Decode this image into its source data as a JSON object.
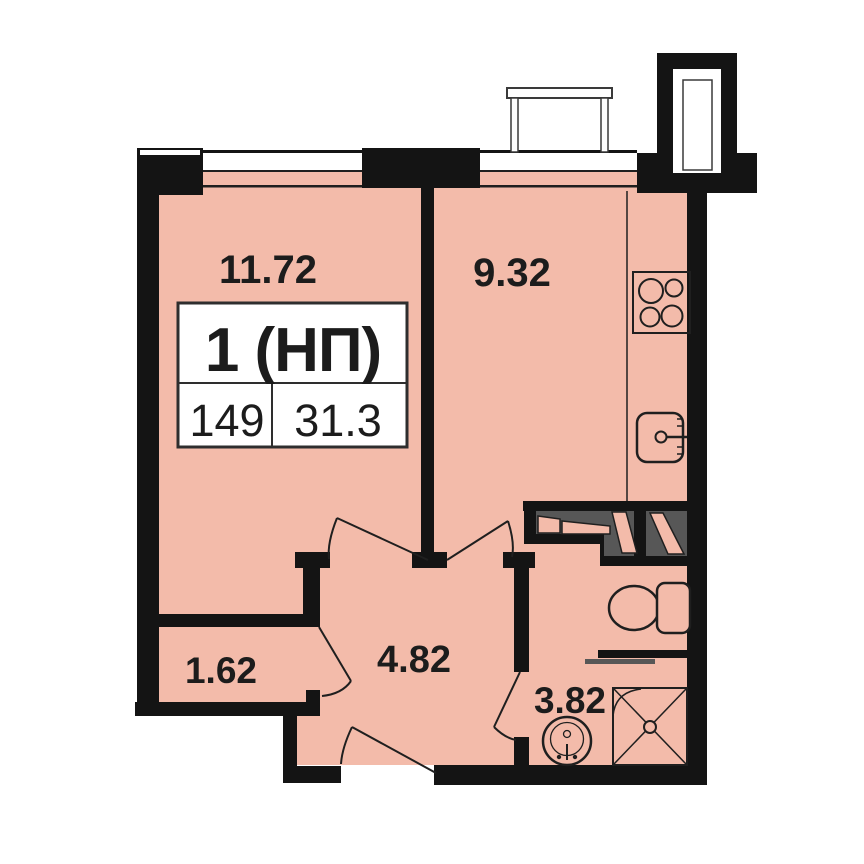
{
  "plan": {
    "title_block": {
      "flat_type": "1 (НП)",
      "flat_number": "149",
      "total_area": "31.3"
    },
    "rooms": {
      "living": {
        "area": "11.72"
      },
      "kitchen": {
        "area": "9.32"
      },
      "storage": {
        "area": "1.62"
      },
      "hall": {
        "area": "4.82"
      },
      "bathroom": {
        "area": "3.82"
      }
    },
    "colors": {
      "room_fill": "#f3bbaa",
      "wall": "#141414",
      "cabinet_gray": "#575757",
      "line": "#1f1f1f",
      "background": "#ffffff"
    },
    "icons": [
      "stove-icon",
      "kitchen-sink-icon",
      "toilet-icon",
      "washbasin-icon",
      "shower-icon",
      "balcony-railing-icon",
      "ventilation-shaft-icon"
    ]
  }
}
